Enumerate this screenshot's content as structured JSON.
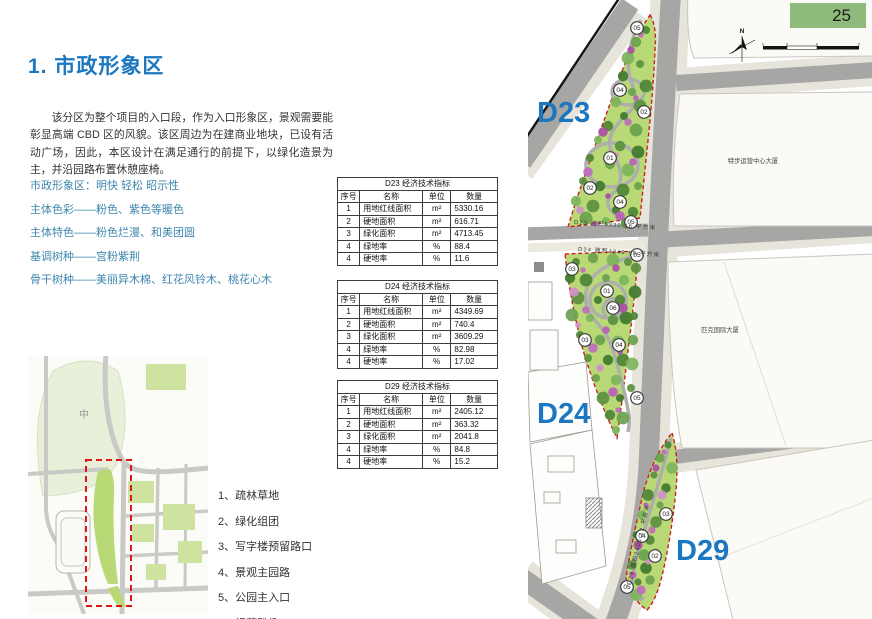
{
  "page": {
    "number": "25"
  },
  "title": "1. 市政形象区",
  "paragraph": "该分区为整个项目的入口段，作为入口形象区，景观需要能彰显高端 CBD 区的风貌。该区周边为在建商业地块，已设有活动广场，因此，本区设计在满足通行的前提下，以绿化造景为主，并沿园路布置休憩座椅。",
  "features": [
    "市政形象区：明快 轻松 昭示性",
    "主体色彩——粉色、紫色等暖色",
    "主体特色——粉色烂漫、和美团圆",
    "基调树种——宫粉紫荆",
    "骨干树种——美丽异木棉、红花风铃木、桃花心木"
  ],
  "legend": [
    "1、疏林草地",
    "2、绿化组团",
    "3、写字楼预留路口",
    "4、景观主园路",
    "5、公园主入口",
    "6、绿荫雅趣"
  ],
  "tables": [
    {
      "title": "D23 经济技术指标",
      "headers": [
        "序号",
        "名称",
        "单位",
        "数量"
      ],
      "rows": [
        [
          "1",
          "用地红线面积",
          "m²",
          "5330.16"
        ],
        [
          "2",
          "硬地面积",
          "m²",
          "616.71"
        ],
        [
          "3",
          "绿化面积",
          "m²",
          "4713.45"
        ],
        [
          "4",
          "绿地率",
          "%",
          "88.4"
        ],
        [
          "4",
          "硬地率",
          "%",
          "11.6"
        ]
      ]
    },
    {
      "title": "D24 经济技术指标",
      "headers": [
        "序号",
        "名称",
        "单位",
        "数量"
      ],
      "rows": [
        [
          "1",
          "用地红线面积",
          "m²",
          "4349.69"
        ],
        [
          "2",
          "硬地面积",
          "m²",
          "740.4"
        ],
        [
          "3",
          "绿化面积",
          "m²",
          "3609.29"
        ],
        [
          "4",
          "绿地率",
          "%",
          "82.98"
        ],
        [
          "4",
          "硬地率",
          "%",
          "17.02"
        ]
      ]
    },
    {
      "title": "D29 经济技术指标",
      "headers": [
        "序号",
        "名称",
        "单位",
        "数量"
      ],
      "rows": [
        [
          "1",
          "用地红线面积",
          "m²",
          "2405.12"
        ],
        [
          "2",
          "硬地面积",
          "m²",
          "363.32"
        ],
        [
          "3",
          "绿化面积",
          "m²",
          "2041.8"
        ],
        [
          "4",
          "绿地率",
          "%",
          "84.8"
        ],
        [
          "4",
          "硬地率",
          "%",
          "15.2"
        ]
      ]
    }
  ],
  "map": {
    "d23_label": "D23",
    "d24_label": "D24",
    "d29_label": "D29",
    "d23_markers": [
      "05",
      "04",
      "02",
      "01",
      "02",
      "04",
      "05"
    ],
    "d24_markers": [
      "05",
      "03",
      "01",
      "06",
      "03",
      "04",
      "05"
    ],
    "d29_markers": [
      "03",
      "04",
      "02",
      "05"
    ],
    "annotations": {
      "d23": "D23 面积5330.16 平方米",
      "d24": "D24 面积4349.69 平方米",
      "d29": "D29 面积2405.12 平方米"
    },
    "buildings": {
      "tebu": "特步运营中心大厦",
      "pike": "匹克国际大厦"
    },
    "compass_n": "N",
    "locator_label": "中"
  },
  "colors": {
    "accent_blue": "#1b77c0",
    "feature_teal": "#3d86ad",
    "page_badge_green": "#8eba7c",
    "park_green": "#b9d977",
    "boundary_red": "#cc2020"
  }
}
